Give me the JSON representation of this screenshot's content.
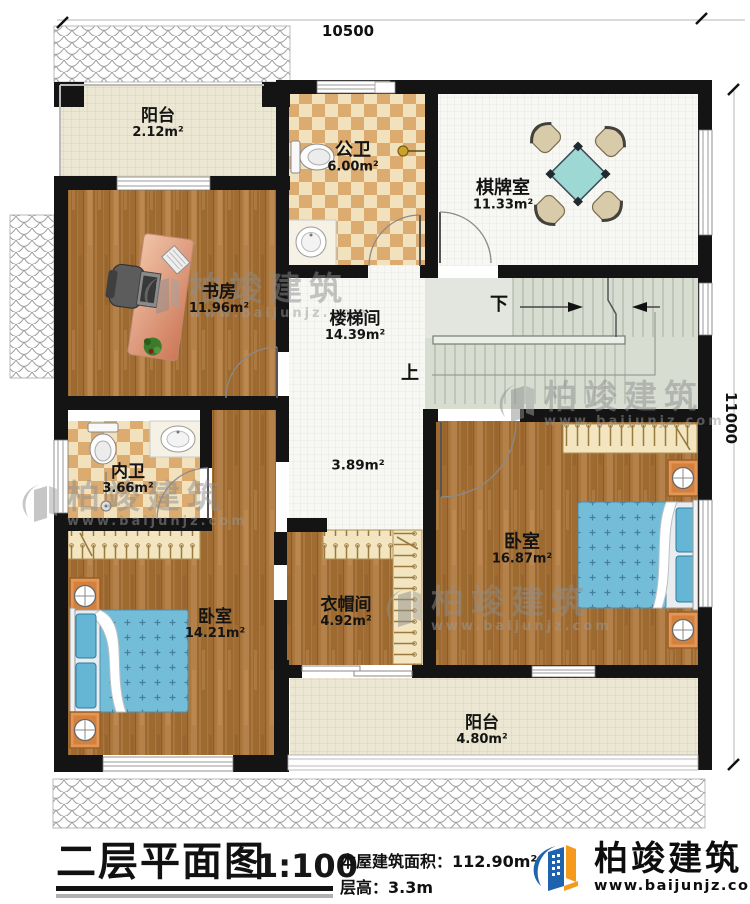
{
  "dimensions": {
    "top": "10500",
    "right": "11000"
  },
  "rooms": {
    "balcony_top": {
      "name": "阳台",
      "area": "2.12m²"
    },
    "public_bath": {
      "name": "公卫",
      "area": "6.00m²"
    },
    "game_room": {
      "name": "棋牌室",
      "area": "11.33m²"
    },
    "study": {
      "name": "书房",
      "area": "11.96m²"
    },
    "stairwell": {
      "name": "楼梯间",
      "area": "14.39m²"
    },
    "hall": {
      "area": "3.89m²"
    },
    "inner_bath": {
      "name": "内卫",
      "area": "3.66m²"
    },
    "bedroom_right": {
      "name": "卧室",
      "area": "16.87m²"
    },
    "cloakroom": {
      "name": "衣帽间",
      "area": "4.92m²"
    },
    "bedroom_left": {
      "name": "卧室",
      "area": "14.21m²"
    },
    "balcony_bottom": {
      "name": "阳台",
      "area": "4.80m²"
    }
  },
  "stairs": {
    "down": "下",
    "up": "上"
  },
  "footer": {
    "title": "二层平面图",
    "scale": "1:100",
    "building_area": "本屋建筑面积：112.90m²",
    "floor_height": "层高：3.3m"
  },
  "brand": {
    "name": "柏竣建筑",
    "website": "www.baijunjz.com"
  },
  "watermark": {
    "name": "柏竣建筑",
    "website": "www.baijunjz.com"
  },
  "colors": {
    "wall": "#141414",
    "wood_floor": "#ab773c",
    "checker_light": "#f2e1bd",
    "checker_dark": "#dcab70",
    "tile_white": "#f7f7f4",
    "grid_cream": "#ebe7d2",
    "stair_green": "#d8ddd2",
    "bed_blue": "#74bdd8",
    "table_teal": "#9ed8d4",
    "logo_blue": "#1e63ad",
    "logo_orange": "#f59a1d"
  }
}
